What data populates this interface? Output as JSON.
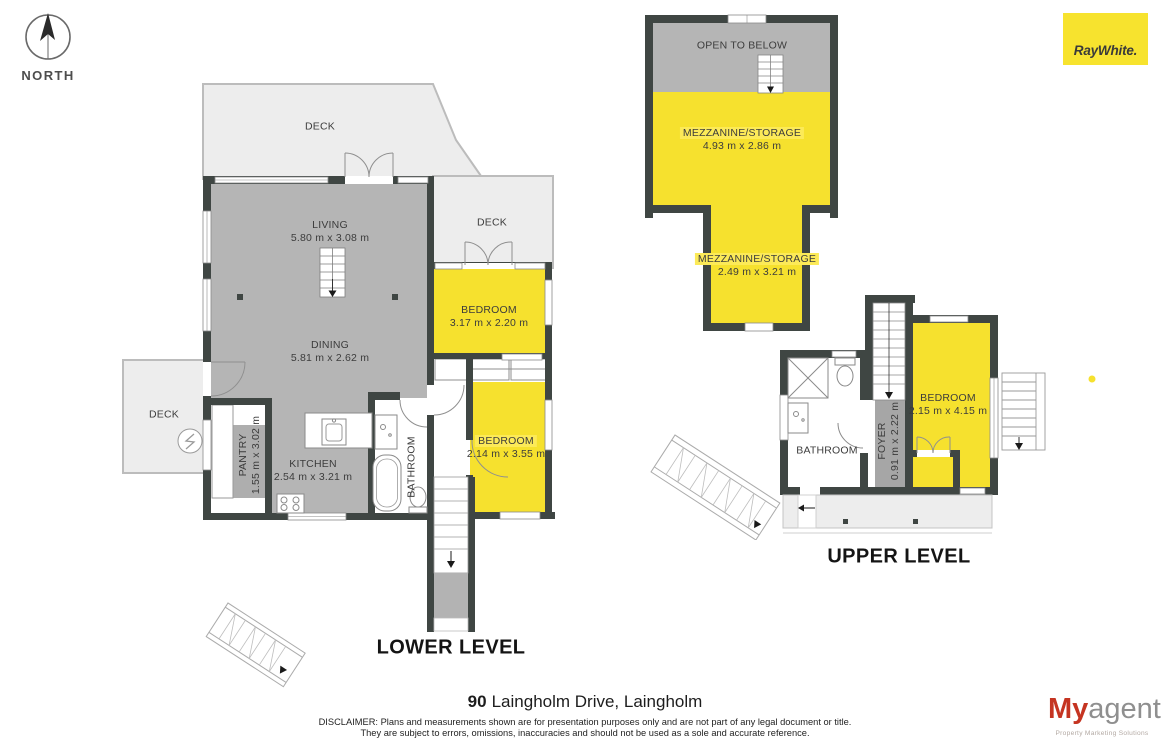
{
  "compass": {
    "label": "NORTH"
  },
  "branding": {
    "raywhite_logo": "RayWhite.",
    "myagent": {
      "prefix": "My",
      "suffix": "agent",
      "tagline": "Property Marketing Solutions"
    }
  },
  "lower_level": {
    "title": "LOWER LEVEL",
    "decks": {
      "top": "DECK",
      "right": "DECK",
      "left": "DECK"
    },
    "living": {
      "name": "LIVING",
      "dims": "5.80 m x 3.08 m"
    },
    "dining": {
      "name": "DINING",
      "dims": "5.81 m x 2.62 m"
    },
    "kitchen": {
      "name": "KITCHEN",
      "dims": "2.54 m x 3.21 m"
    },
    "pantry": {
      "name": "PANTRY",
      "dims": "1.55 m x 3.02 m"
    },
    "bathroom": {
      "name": "BATHROOM"
    },
    "bedroom_1": {
      "name": "BEDROOM",
      "dims": "3.17 m x 2.20 m"
    },
    "bedroom_2": {
      "name": "BEDROOM",
      "dims": "2.14 m x 3.55 m"
    }
  },
  "upper_level": {
    "title": "UPPER LEVEL",
    "open_to_below": "OPEN TO BELOW",
    "mezzanine_1": {
      "name": "MEZZANINE/STORAGE",
      "dims": "4.93 m x 2.86 m"
    },
    "mezzanine_2": {
      "name": "MEZZANINE/STORAGE",
      "dims": "2.49 m x 3.21 m"
    },
    "bedroom": {
      "name": "BEDROOM",
      "dims": "2.15 m x 4.15 m"
    },
    "bathroom": {
      "name": "BATHROOM"
    },
    "foyer": {
      "name": "FOYER",
      "dims": "0.91 m x 2.22 m"
    }
  },
  "footer": {
    "address_number": "90",
    "address_rest": "Laingholm Drive, Laingholm",
    "disclaimer_line_1": "DISCLAIMER: Plans and measurements shown are for presentation purposes only and are not part of any legal document or title.",
    "disclaimer_line_2": "They are subject to errors, omissions, inaccuracies and should not be used as a sole and accurate reference."
  },
  "colors": {
    "accent_yellow": "#f6e12e",
    "wall_dark": "#3f4643",
    "floor_gray": "#b5b5b5",
    "deck_gray": "#ededed",
    "myagent_red": "#c53421"
  }
}
